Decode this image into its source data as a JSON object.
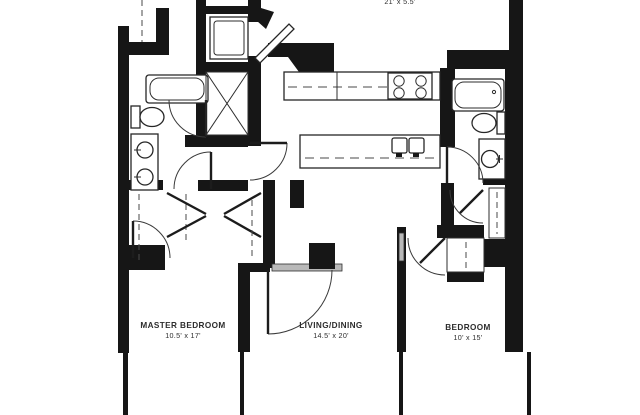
{
  "plan": {
    "rooms": [
      {
        "name": "MASTER BEDROOM",
        "dims": "10.5' x 17'"
      },
      {
        "name": "LIVING/DINING",
        "dims": "14.5' x 20'"
      },
      {
        "name": "BEDROOM",
        "dims": "10' x 15'"
      }
    ],
    "top_area_dims": "21' x 5.5'",
    "colors": {
      "wall": "#161616",
      "line": "#2e2e2e",
      "door_sill": "#b9b9b9",
      "background": "#ffffff"
    }
  }
}
